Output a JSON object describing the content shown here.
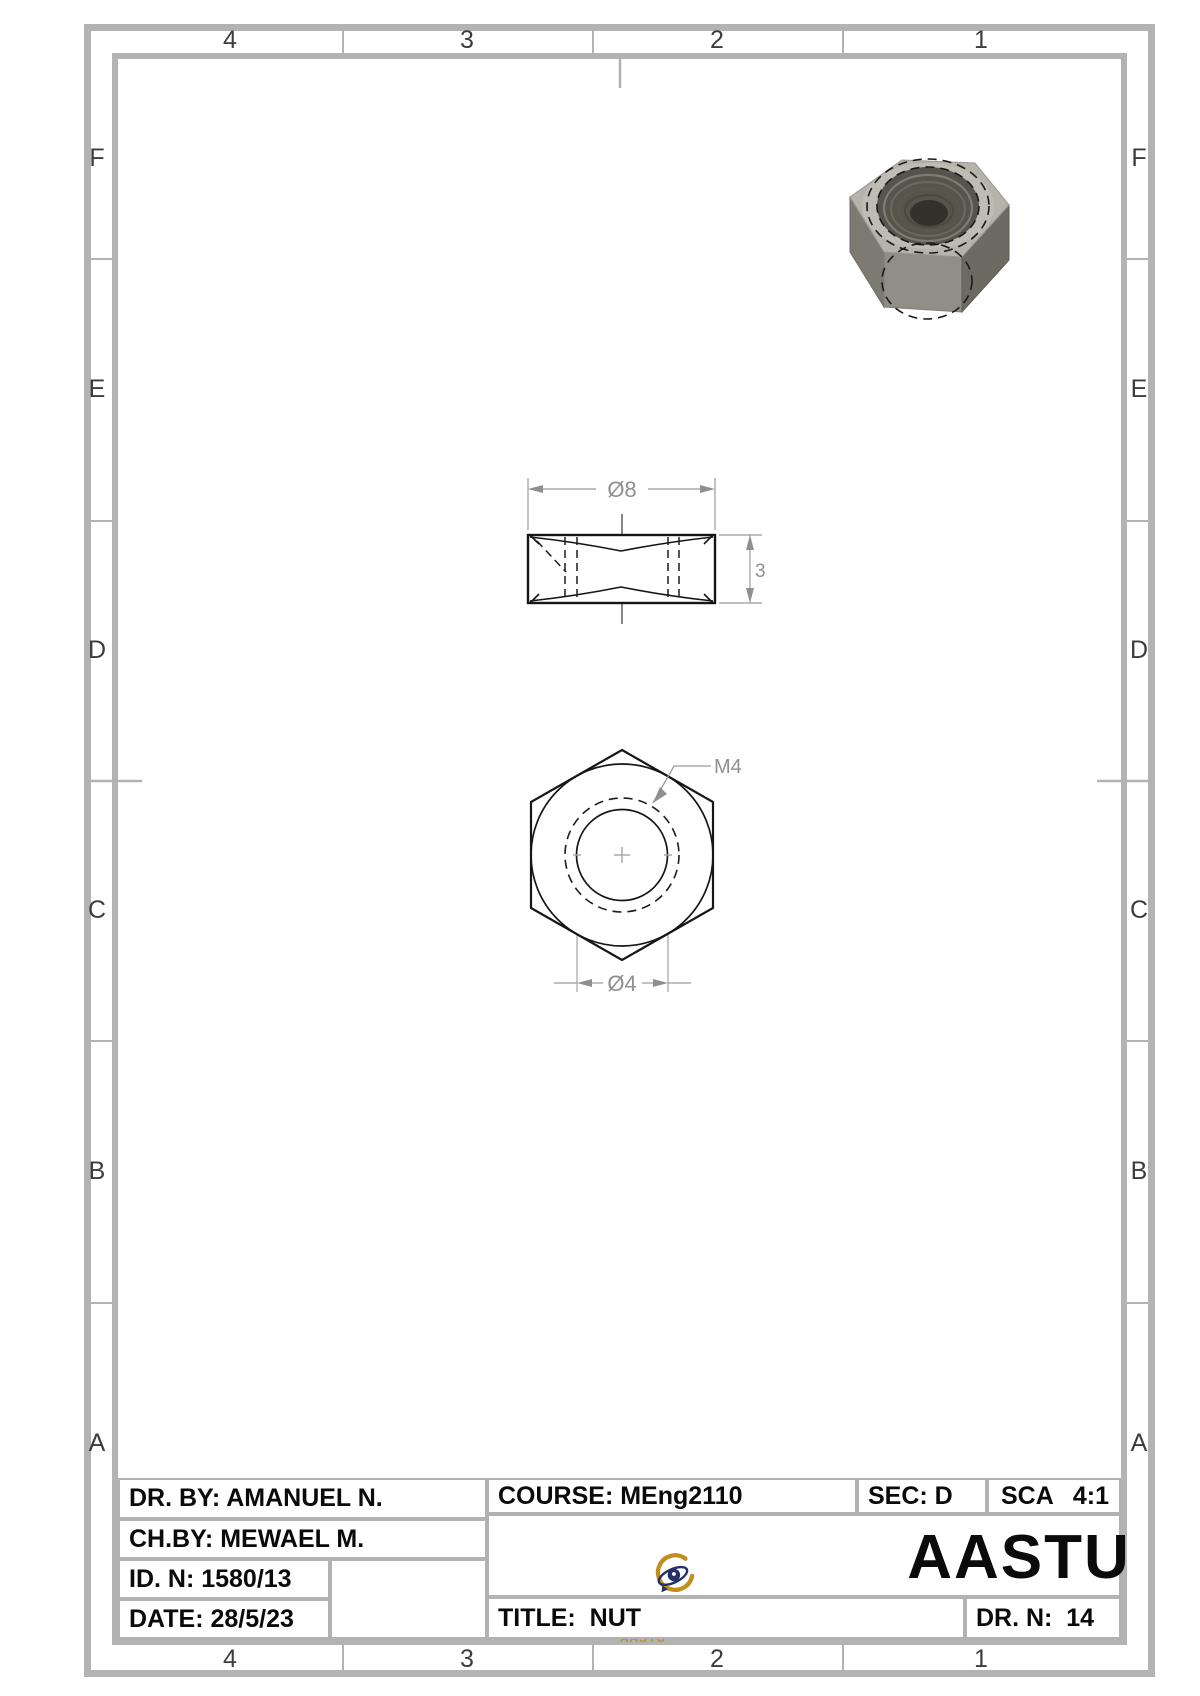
{
  "sheet": {
    "zone_columns_top": [
      "4",
      "3",
      "2",
      "1"
    ],
    "zone_columns_bottom": [
      "4",
      "3",
      "2",
      "1"
    ],
    "zone_rows_left": [
      "F",
      "E",
      "D",
      "C",
      "B",
      "A"
    ],
    "zone_rows_right": [
      "F",
      "E",
      "D",
      "C",
      "B",
      "A"
    ]
  },
  "drawing": {
    "front_view": {
      "width_dim": "Ø8",
      "height_dim": "3"
    },
    "top_view": {
      "hole_dim": "Ø4",
      "thread_callout": "M4"
    }
  },
  "title_block": {
    "drawn_by": "DR. BY: AMANUEL N.",
    "checked_by": "CH.BY: MEWAEL M.",
    "id_number": "ID. N: 1580/13",
    "date": "DATE: 28/5/23",
    "course": "COURSE: MEng2110",
    "section": "SEC: D",
    "scale_label": "SCA",
    "scale_value": "4:1",
    "university_name": "AASTU",
    "logo_caption": "AASTU",
    "title": "TITLE:  NUT",
    "drawing_number": "DR. N:  14"
  },
  "colors": {
    "frame_gray": "#b3b3b3",
    "model_line": "#161616",
    "dimension_gray": "#8f8f8f",
    "logo_gold": "#c28f1e",
    "logo_navy": "#253066"
  }
}
